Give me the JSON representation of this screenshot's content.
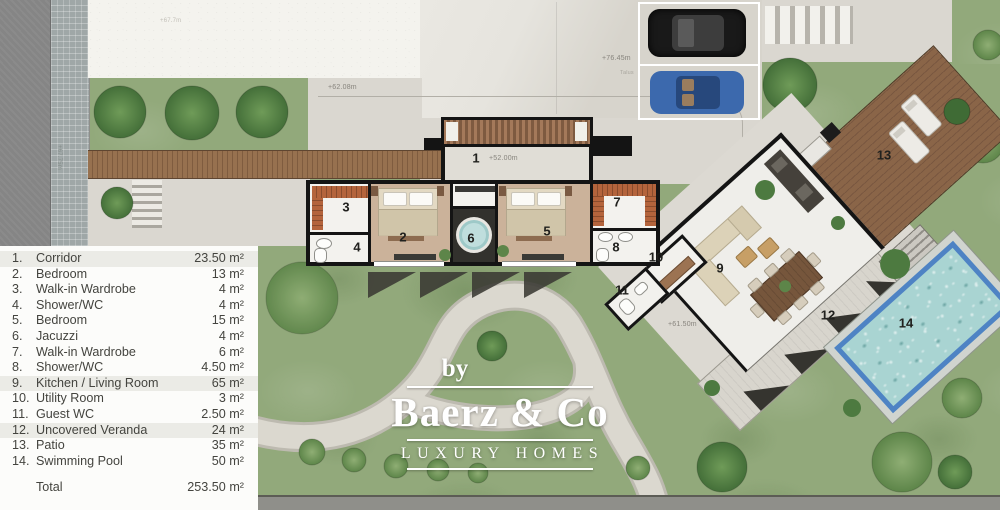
{
  "legend": {
    "items": [
      {
        "num": "1.",
        "name": "Corridor",
        "area": "23.50 m²"
      },
      {
        "num": "2.",
        "name": "Bedroom",
        "area": "13 m²"
      },
      {
        "num": "3.",
        "name": "Walk-in Wardrobe",
        "area": "4 m²"
      },
      {
        "num": "4.",
        "name": "Shower/WC",
        "area": "4 m²"
      },
      {
        "num": "5.",
        "name": "Bedroom",
        "area": "15 m²"
      },
      {
        "num": "6.",
        "name": "Jacuzzi",
        "area": "4 m²"
      },
      {
        "num": "7.",
        "name": "Walk-in Wardrobe",
        "area": "6 m²"
      },
      {
        "num": "8.",
        "name": "Shower/WC",
        "area": "4.50 m²"
      },
      {
        "num": "9.",
        "name": "Kitchen / Living Room",
        "area": "65 m²"
      },
      {
        "num": "10.",
        "name": "Utility Room",
        "area": "3 m²"
      },
      {
        "num": "11.",
        "name": "Guest WC",
        "area": "2.50 m²"
      },
      {
        "num": "12.",
        "name": "Uncovered Veranda",
        "area": "24 m²"
      },
      {
        "num": "13.",
        "name": "Patio",
        "area": "35 m²"
      },
      {
        "num": "14.",
        "name": "Swimming Pool",
        "area": "50 m²"
      }
    ],
    "total_label": "Total",
    "total_value": "253.50 m²"
  },
  "watermark": {
    "by": "by",
    "brand": "Baerz & Co",
    "tagline": "LUXURY HOMES"
  },
  "plan": {
    "rooms": {
      "r1": "1",
      "r2": "2",
      "r3": "3",
      "r4": "4",
      "r5": "5",
      "r6": "6",
      "r7": "7",
      "r8": "8",
      "r9": "9",
      "r10": "10",
      "r11": "11",
      "r12": "12",
      "r13": "13",
      "r14": "14"
    },
    "elevations": {
      "street_upper": "+67.7m",
      "street_side": "+67.75m",
      "driveway": "+62.08m",
      "parking": "+76.45m",
      "parking_note": "Talus",
      "corridor": "+52.00m",
      "veranda": "+61.50m"
    }
  },
  "colors": {
    "pool_border": "#4e83c4",
    "pool_water": "#a9d4d2",
    "deck_wood": "#8a6548",
    "garden_green": "#92a97b",
    "wall_black": "#141414"
  }
}
